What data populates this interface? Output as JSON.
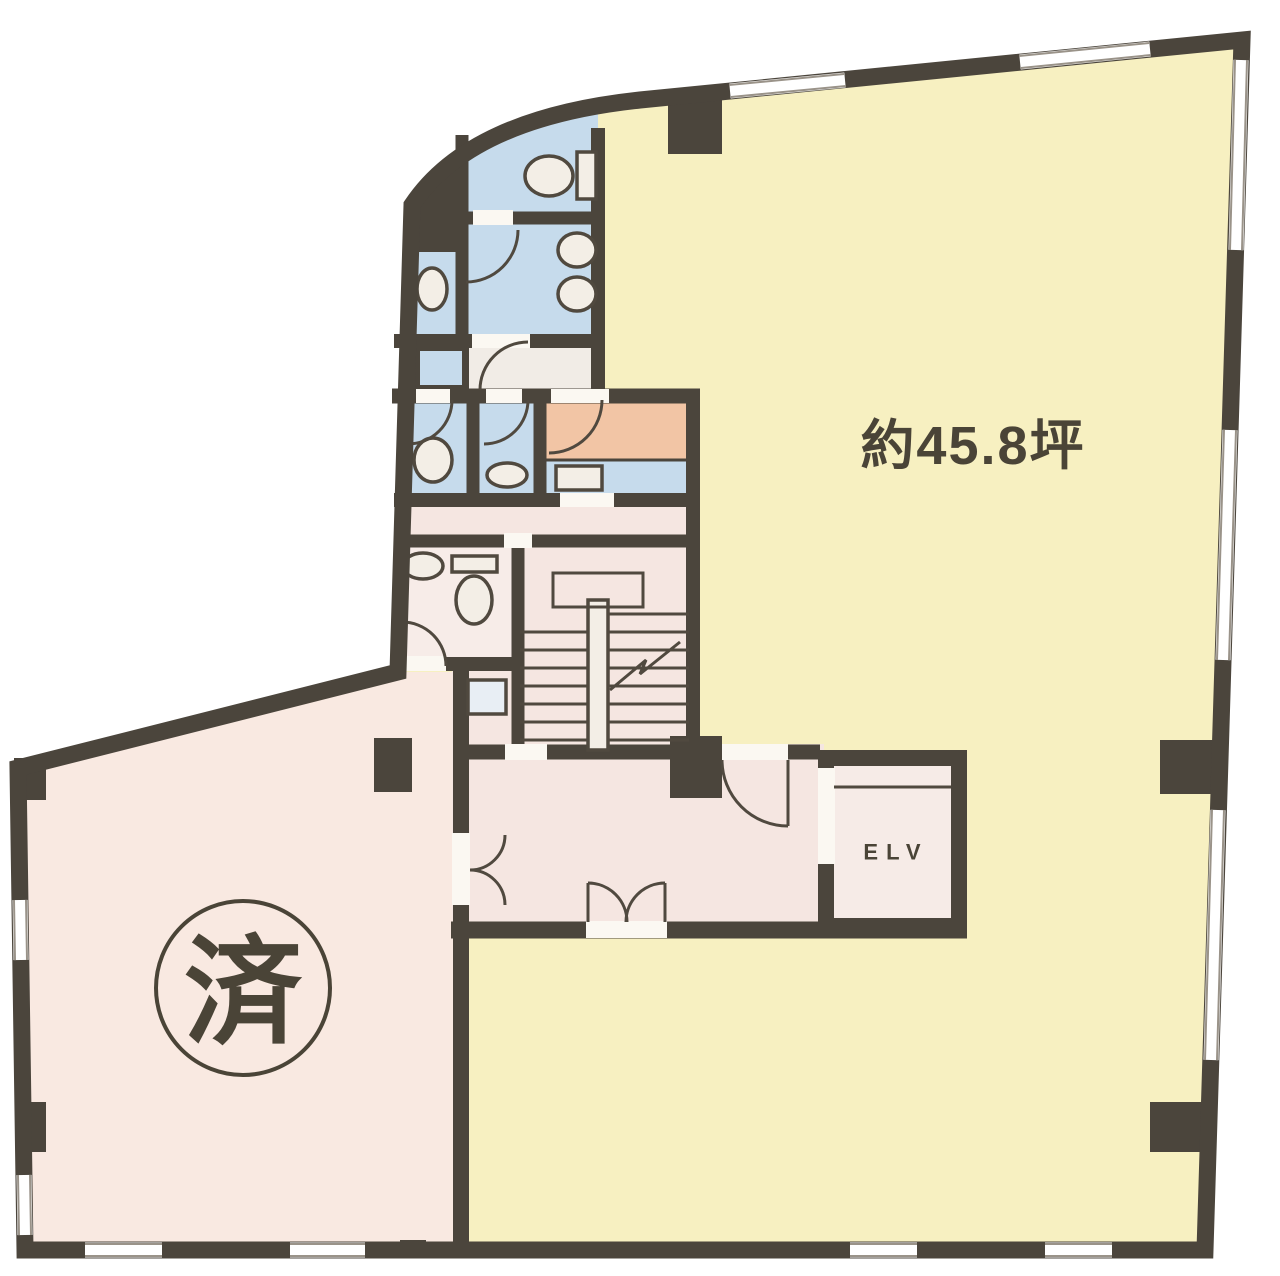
{
  "plan": {
    "labels": {
      "area": "約45.8坪",
      "elevator": "ELV",
      "stamp": "済"
    },
    "colors": {
      "wall": "#4b453c",
      "outline": "#50493f",
      "main_room": "#f7f0c1",
      "left_room": "#f9e9e1",
      "hall": "#f5e6e1",
      "toilet_room": "#f7ece8",
      "wet_area": "#c6dbec",
      "service_room": "#f2c5a5",
      "lobby": "#f1ece6",
      "elevator_cab": "#f6ebe7",
      "shaft_box": "#e8eef4",
      "fixture": "#f3eee6",
      "door_gap": "#fbf8f2",
      "window_fill": "#ffffff",
      "window_line": "#9a9389",
      "text": "#4a4437",
      "background": "#ffffff"
    }
  }
}
